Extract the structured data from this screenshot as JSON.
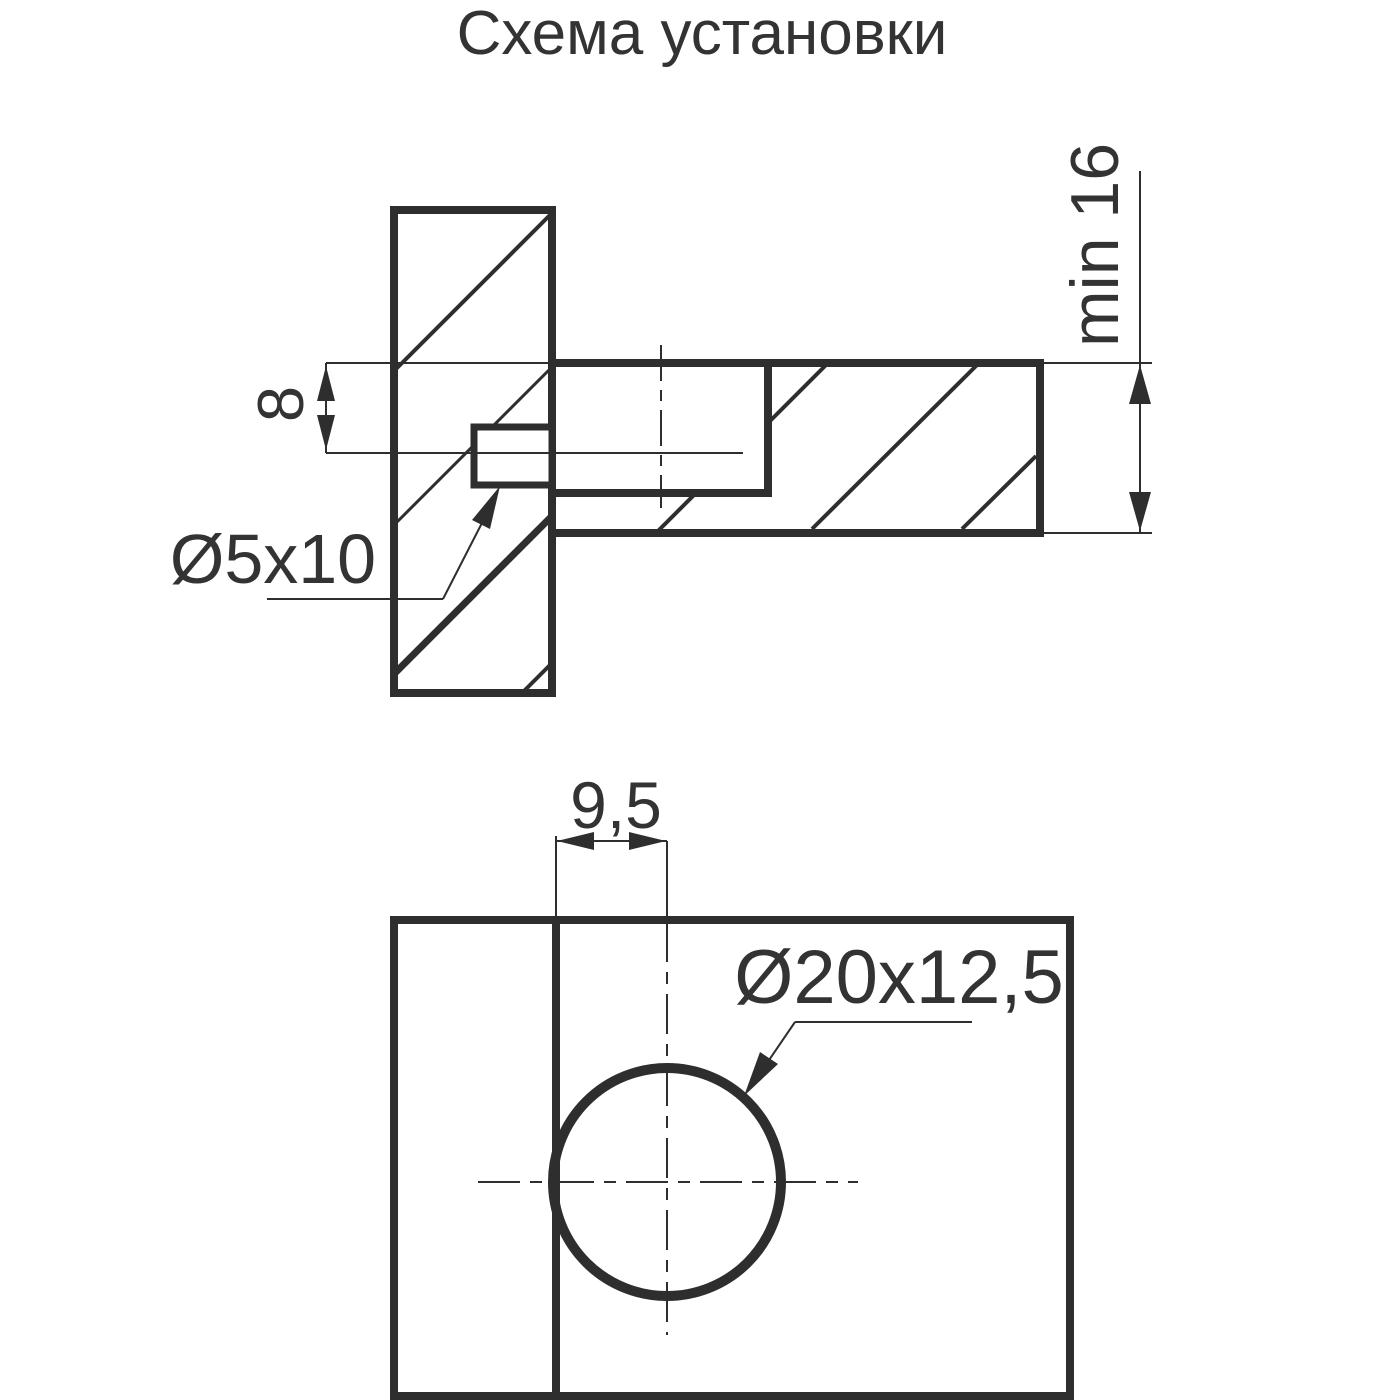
{
  "title": "Схема установки",
  "colors": {
    "background": "#ffffff",
    "line": "#2e2e2e",
    "text": "#333333"
  },
  "views": {
    "side_section": {
      "dim_offset": {
        "label": "8"
      },
      "dim_dowel": {
        "label": "Ø5x10"
      },
      "dim_depth": {
        "label": "min 16"
      }
    },
    "front": {
      "dim_center_offset": {
        "label": "9,5"
      },
      "dim_hole": {
        "label": "Ø20x12,5"
      }
    }
  }
}
